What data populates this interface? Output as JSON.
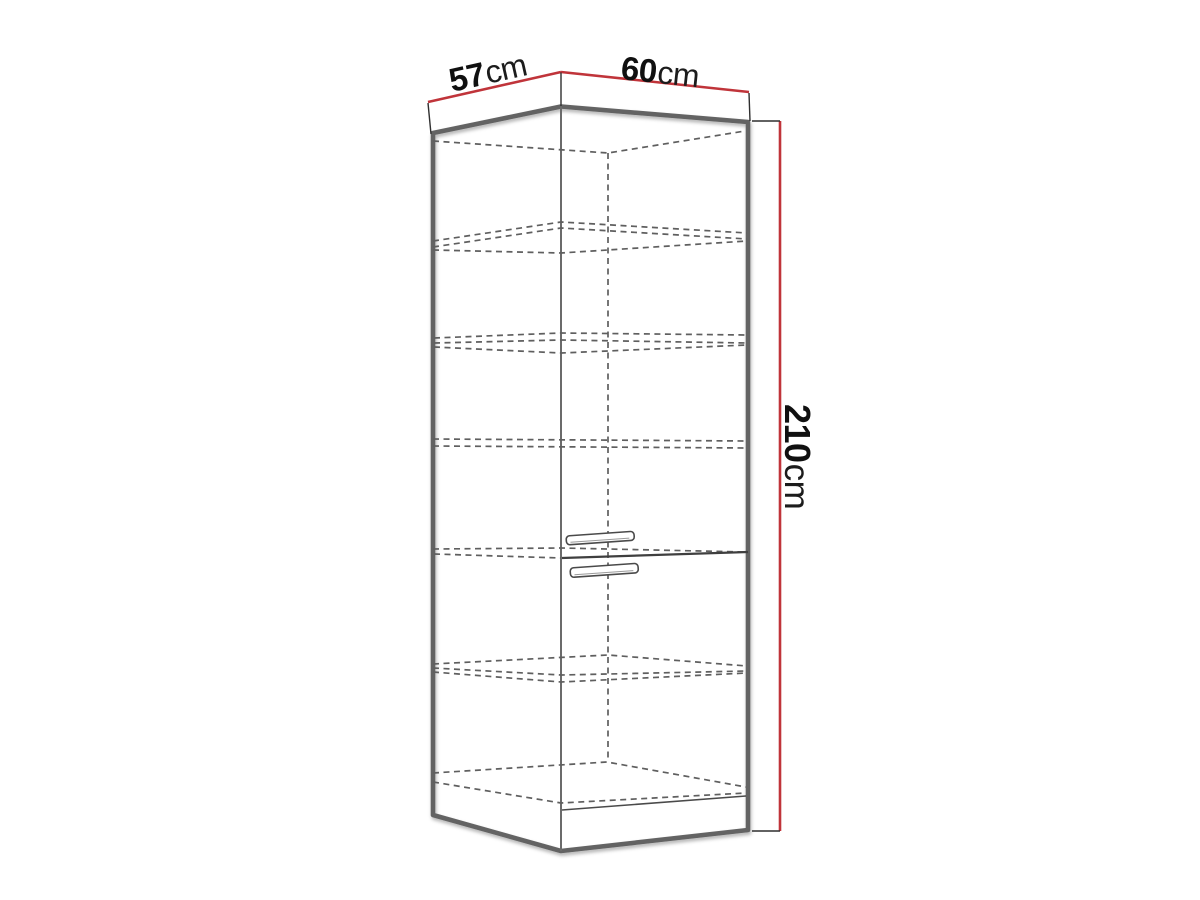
{
  "page": {
    "background": "#ffffff"
  },
  "diagram": {
    "type": "furniture dimension drawing",
    "subject": "tall corner kitchen cabinet, two doors, five interior shelves, shown in perspective with red dimension lines",
    "labels": {
      "depth": {
        "value": "57",
        "unit": "cm"
      },
      "width": {
        "value": "60",
        "unit": "cm"
      },
      "height": {
        "value": "210",
        "unit": "cm"
      }
    },
    "colors": {
      "dimension-line": "#c0343a",
      "outline": "#636363",
      "interior-line": "#5f5f5f",
      "label-text": "#101010",
      "background": "#ffffff"
    }
  }
}
